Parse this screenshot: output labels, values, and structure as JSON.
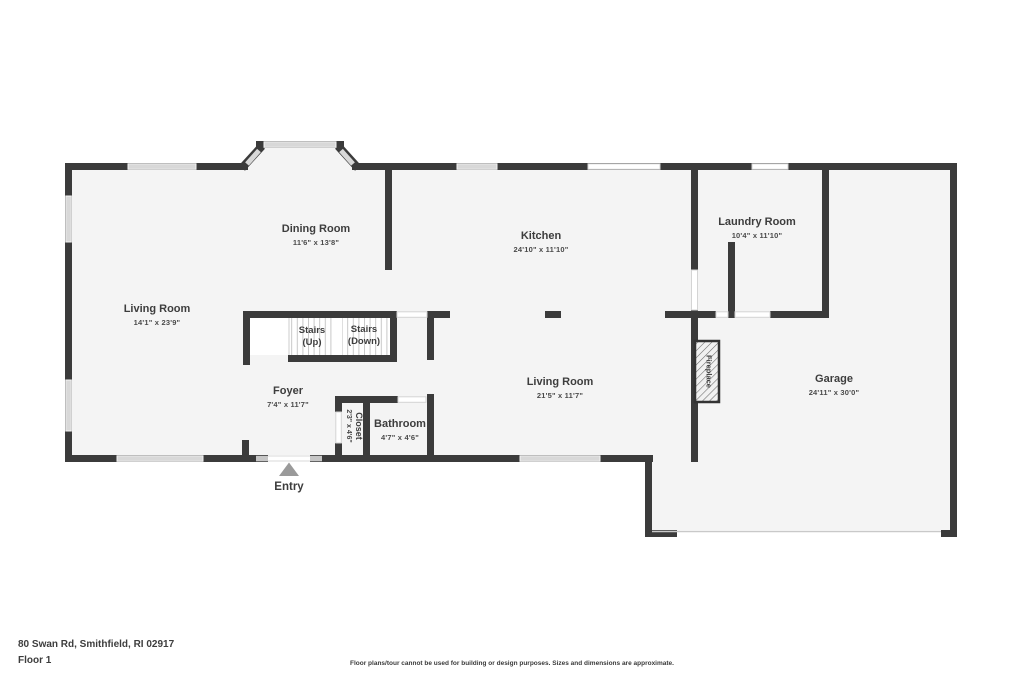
{
  "plan": {
    "address": "80 Swan Rd, Smithfield, RI 02917",
    "floor_label": "Floor 1",
    "disclaimer": "Floor plans/tour cannot be used for building or design purposes. Sizes and dimensions are approximate.",
    "entry_label": "Entry",
    "fireplace_label": "Fireplace",
    "stairs_up": {
      "line1": "Stairs",
      "line2": "(Up)"
    },
    "stairs_down": {
      "line1": "Stairs",
      "line2": "(Down)"
    },
    "rooms": [
      {
        "name": "Living Room",
        "dimensions": "14'1\" x 23'9\""
      },
      {
        "name": "Dining Room",
        "dimensions": "11'6\" x 13'8\""
      },
      {
        "name": "Kitchen",
        "dimensions": "24'10\" x 11'10\""
      },
      {
        "name": "Laundry Room",
        "dimensions": "10'4\" x 11'10\""
      },
      {
        "name": "Living Room",
        "dimensions": "21'5\" x 11'7\""
      },
      {
        "name": "Garage",
        "dimensions": "24'11\" x 30'0\""
      },
      {
        "name": "Foyer",
        "dimensions": "7'4\" x 11'7\""
      },
      {
        "name": "Bathroom",
        "dimensions": "4'7\" x 4'6\""
      },
      {
        "name": "Closet",
        "dimensions": "2'3\" x 4'6\""
      }
    ],
    "colors": {
      "wall": "#3b3b3b",
      "floor": "#f4f4f4",
      "window": "#d8d8d8",
      "text": "#3d3d3d",
      "background": "#ffffff"
    }
  }
}
